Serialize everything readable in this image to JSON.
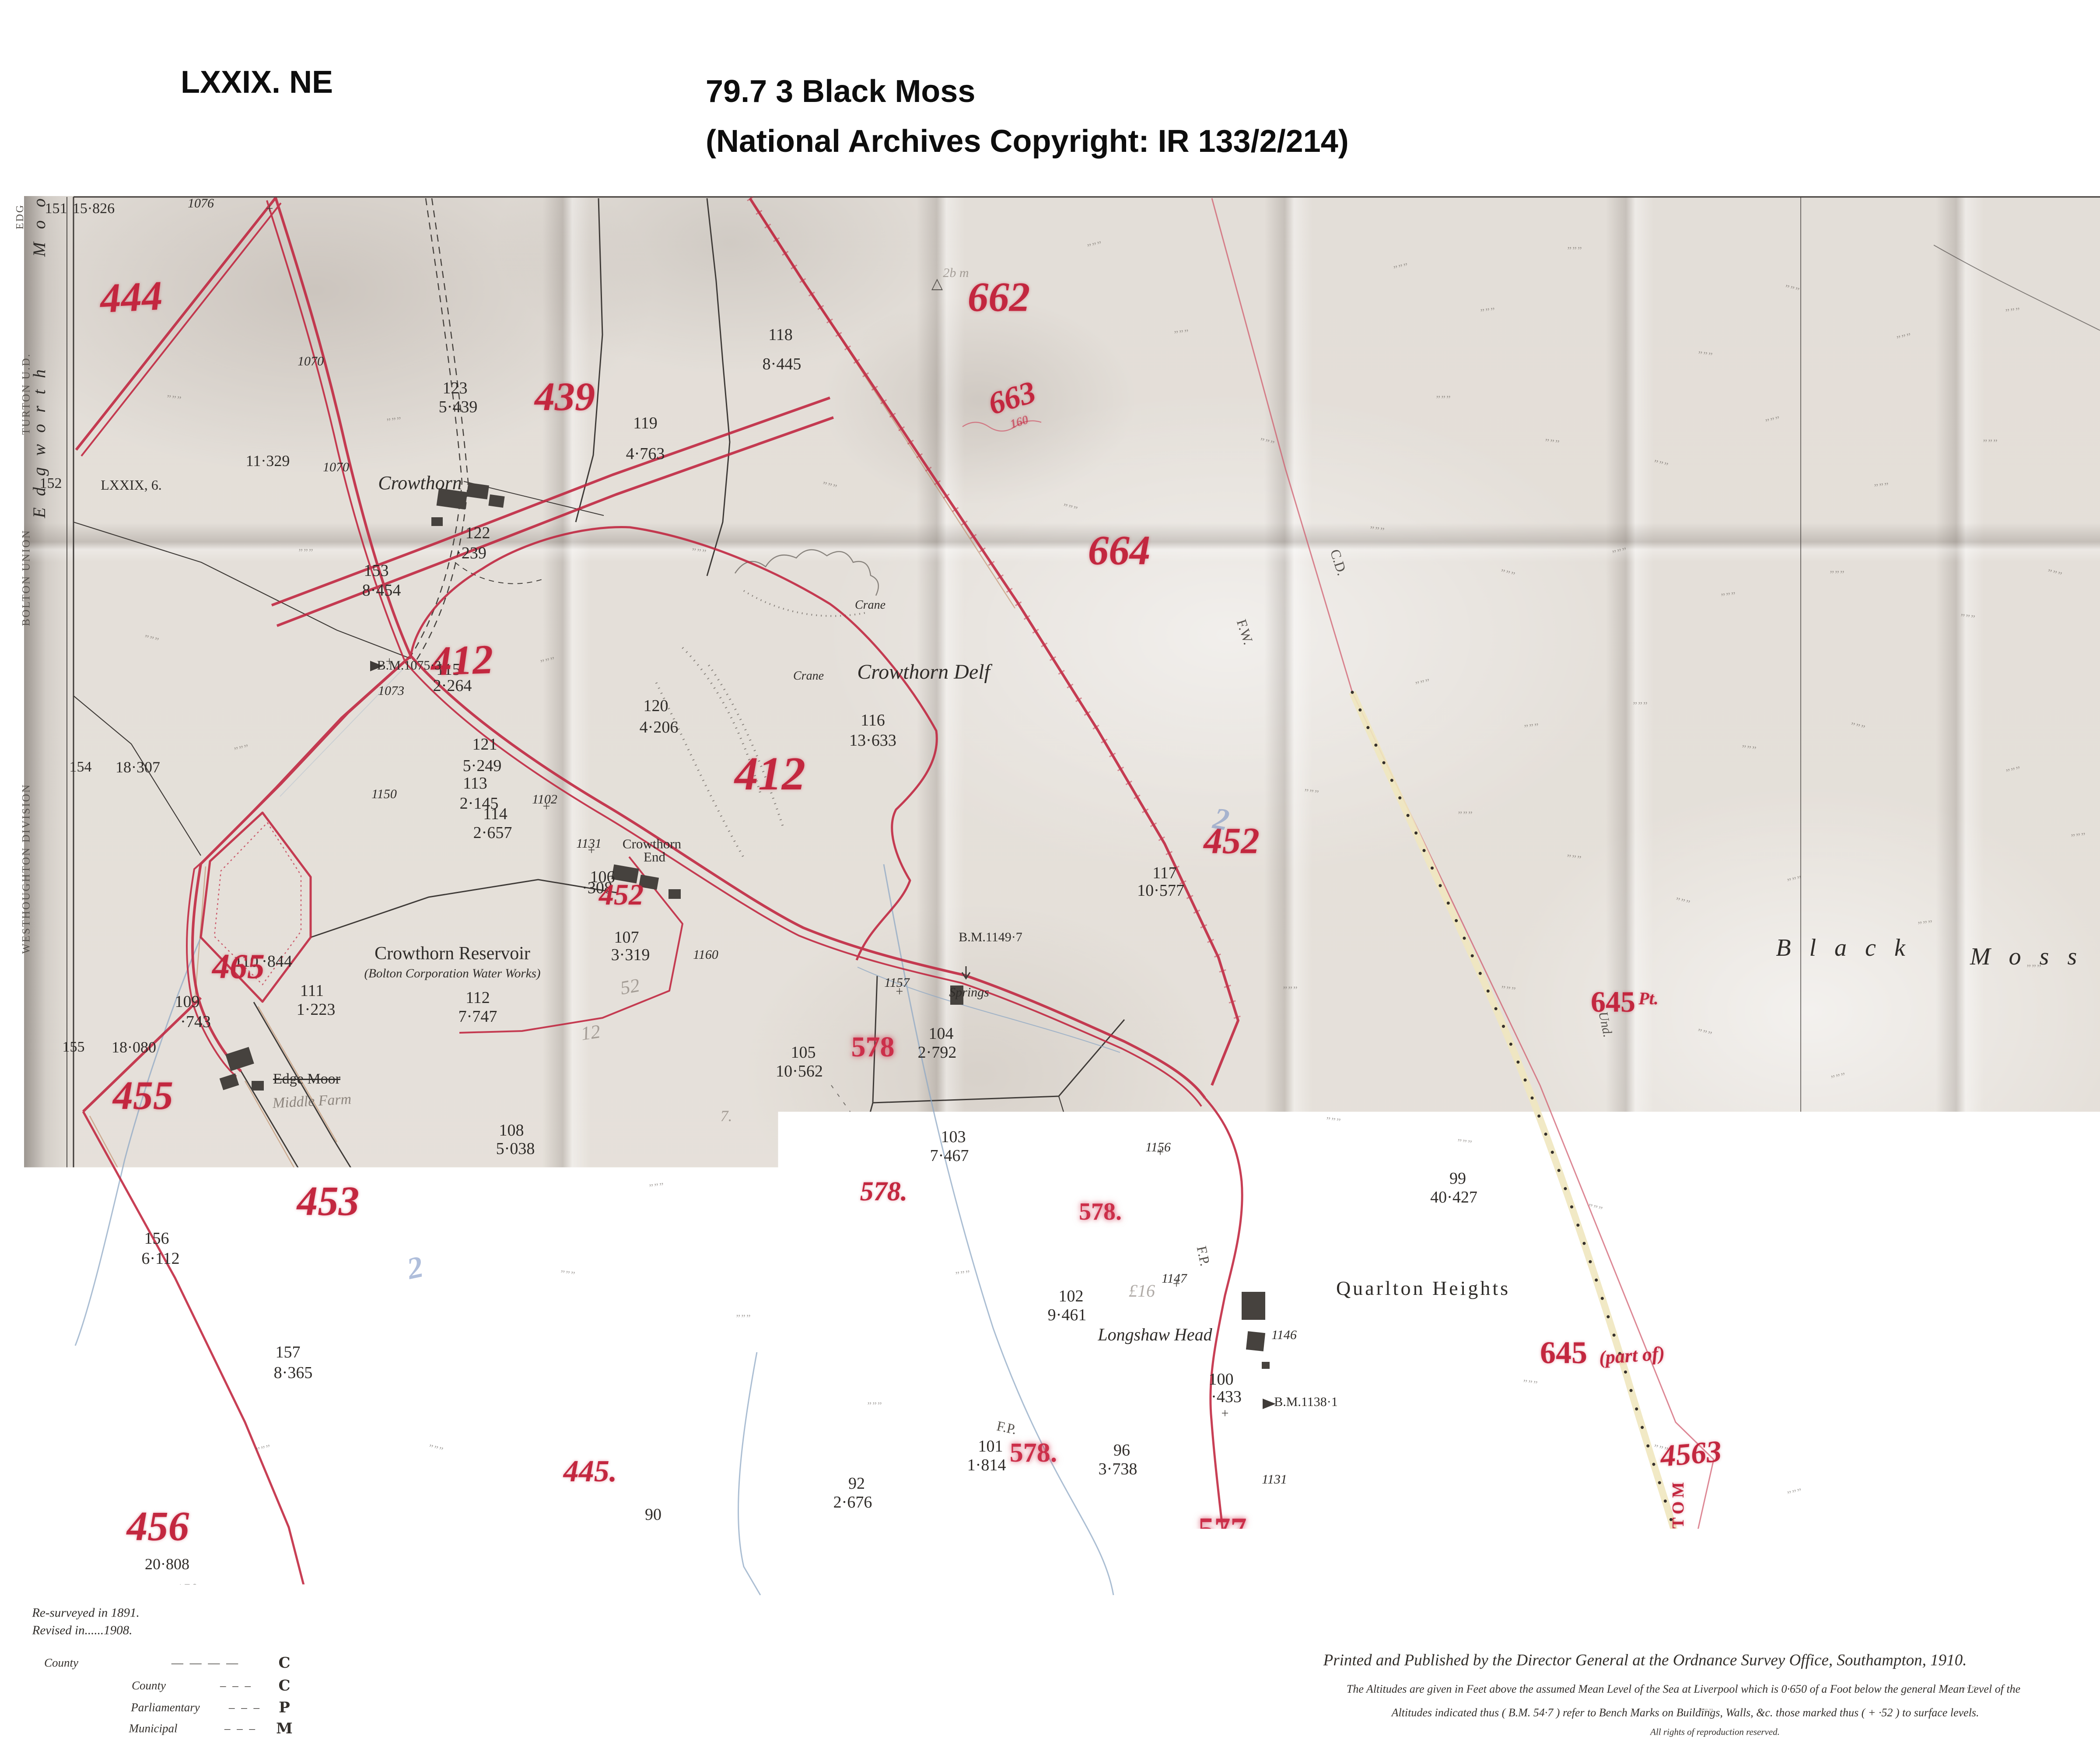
{
  "header": {
    "sheet_ref": "LXXIX. NE",
    "title_line1": "79.7 3 Black Moss",
    "title_line2": "(National Archives Copyright: IR 133/2/214)"
  },
  "margin": {
    "edge_top": "EDG",
    "moor_vertical": "M o o",
    "turton": "TURTON U.D.",
    "edgworth_vertical": "E d g w o r t h",
    "bolton": "BOLTON UNION",
    "westhoughton": "WESTHOUGHTON DIVISION",
    "n151": "151",
    "a151": "15·826",
    "n152": "152",
    "sheet152": "LXXIX, 6.",
    "a152": "11·329",
    "n154": "154",
    "a154": "18·307",
    "n155": "155",
    "a155": "18·080",
    "n158": "158",
    "a158": "20·808"
  },
  "map": {
    "names": {
      "crowthorn": "Crowthorn",
      "crane1": "Crane",
      "crane2": "Crane",
      "delf": "Crowthorn Delf",
      "reservoir": "Crowthorn Reservoir",
      "reservoir_sub": "(Bolton Corporation Water Works)",
      "cro_end1": "Crowthorn",
      "cro_end2": "End",
      "edge_moor": "Edge Moor",
      "middle_farm": "Middle Farm",
      "springs": "Springs",
      "longshaw": "Longshaw Head",
      "quarlton": "Quarlton Heights",
      "black1": "Black",
      "black2": "Moss"
    },
    "parcels": [
      {
        "n": "123",
        "a": "5·439"
      },
      {
        "n": "122",
        "a": "·239"
      },
      {
        "n": "119",
        "a": "4·763"
      },
      {
        "n": "118",
        "a": "8·445"
      },
      {
        "n": "120",
        "a": "4·206"
      },
      {
        "n": "121",
        "a": "5·249"
      },
      {
        "n": "153",
        "a": "8·454"
      },
      {
        "n": "116",
        "a": "13·633"
      },
      {
        "n": "115",
        "a": "2·264"
      },
      {
        "n": "113",
        "a": "2·145"
      },
      {
        "n": "114",
        "a": "2·657"
      },
      {
        "n": "106",
        "a": "·308"
      },
      {
        "n": "107",
        "a": "3·319"
      },
      {
        "n": "117",
        "a": "10·577"
      },
      {
        "n": "104",
        "a": "2·792"
      },
      {
        "n": "105",
        "a": "10·562"
      },
      {
        "n": "103",
        "a": "7·467"
      },
      {
        "n": "102",
        "a": "9·461"
      },
      {
        "n": "99",
        "a": "40·427"
      },
      {
        "n": "100",
        "a": "·433"
      },
      {
        "n": "101",
        "a": "1·814"
      },
      {
        "n": "96",
        "a": "3·738"
      },
      {
        "n": "92",
        "a": "2·676"
      },
      {
        "n": "108",
        "a": "5·038"
      },
      {
        "n": "109",
        "a": "·743"
      },
      {
        "n": "110",
        "a": "·844"
      },
      {
        "n": "111",
        "a": "1·223"
      },
      {
        "n": "112",
        "a": "7·747"
      },
      {
        "n": "156",
        "a": "6·112"
      },
      {
        "n": "157",
        "a": "8·365"
      },
      {
        "n": "90",
        "a": "26·015"
      }
    ],
    "red": [
      "444",
      "412",
      "439",
      "662",
      "663",
      "664",
      "412",
      "452",
      "452",
      "465",
      "455",
      "453",
      "578",
      "578.",
      "578.",
      "578.",
      "577",
      "456",
      "445.",
      "4563",
      "645",
      "Pt.",
      "645",
      "(part of)",
      "RAMSBOTTOM"
    ],
    "roadnums": [
      "1076",
      "1070",
      "1070",
      "1073",
      "1150",
      "1102",
      "1131",
      "1160",
      "1157",
      "1156",
      "1147",
      "1146",
      "1131"
    ],
    "bm": [
      "B.M.1075·3",
      "B.M.1149·7",
      "B.M.1138·1"
    ],
    "bl": [
      "C.D.",
      "F.W.",
      "F.P.",
      "F.P.",
      "Und."
    ],
    "bottom": [
      "408",
      "91",
      "·734",
      "93",
      "4·633",
      "94",
      "3·288",
      "95",
      "1·934",
      "97",
      "3·572",
      "98"
    ],
    "pencil": [
      "52",
      "12",
      "7.",
      "£16",
      "2",
      "2",
      "2b m"
    ],
    "red_note": "160",
    "triangle": "△",
    "sheet_next": "LXXIX. II.",
    "tuft_glyph": "„„„",
    "cross_glyph": "+"
  },
  "legend": {
    "resurveyed": "Re-surveyed in 1891.",
    "revised": "Revised in......1908.",
    "title": "CHARACTERISTICS AND SYMBOLS FOR BOUNDARIES, &c.",
    "col1": {
      "county": "County",
      "boroughs": "Boroughs",
      "b_county": "County",
      "b_parl": "Parliamentary",
      "b_mun": "Municipal",
      "l_county": "C",
      "l_bcounty": "C",
      "l_parl": "P",
      "l_mun": "M",
      "d1": "— — — —",
      "d2": "– – –",
      "d3": "– – –",
      "d4": "– – –"
    },
    "col2": {
      "r1": "Municipal Wards",
      "r2": "Urban Districts",
      "r3": "Civil Parishes",
      "r4": "Rural Districts",
      "l1": "W",
      "l2": "D",
      "l3": "P",
      "l4": "R",
      "s1": "· – — – ·",
      "s2": "— — — –",
      "s3": "· · · · · · · ·",
      "s4": "✗ · · · · · · ✗ ·"
    },
    "col3": {
      "line1": "Change of Boundary, indicating the point at",
      "line2": "which the character of a Boundary changes",
      "antiquities": "Antiquities (Site of )",
      "trig": "Trigonometrical Station",
      "poor": "Poor Law Unions",
      "poor_sym": "✗ · · · · · · · ✗ ·",
      "ss": "S.S.",
      "cs": "C.S.",
      "fort": "Fort",
      "tri": "△",
      "u": "U",
      "cross": "✛",
      "brace_label": "3or11"
    },
    "col4": {
      "line1": "Every parcel is numbered thus",
      "num": "27",
      "line2": "Its area is given underneath in Acres, thus",
      "area": "4·370",
      "line3": "Braces indicating that the spaces so connected are",
      "line4": "included in the same reference number and area",
      "note": "For other information see Characteristic Sheet."
    }
  },
  "imprint": {
    "line1": "Printed and Published by the Director General at the Ordnance Survey Office, Southampton, 1910.",
    "line2": "The Altitudes are given in Feet above the assumed Mean Level of the Sea at Liverpool which is 0·650 of a Foot below the general Mean Level of the",
    "line3": "Altitudes indicated thus ( B.M. 54·7 ) refer to Bench Marks on Buildings, Walls, &c. those marked thus ( + ·52 ) to surface levels.",
    "line4": "All rights of reproduction reserved."
  },
  "colors": {
    "boundary_red": "#c0243e",
    "parcel_red": "#c3273f",
    "paper": "#e3ded8",
    "ink_black": "#3a3632",
    "stream_blue": "#8fa9c5",
    "parish_cream": "#efe7bf"
  }
}
